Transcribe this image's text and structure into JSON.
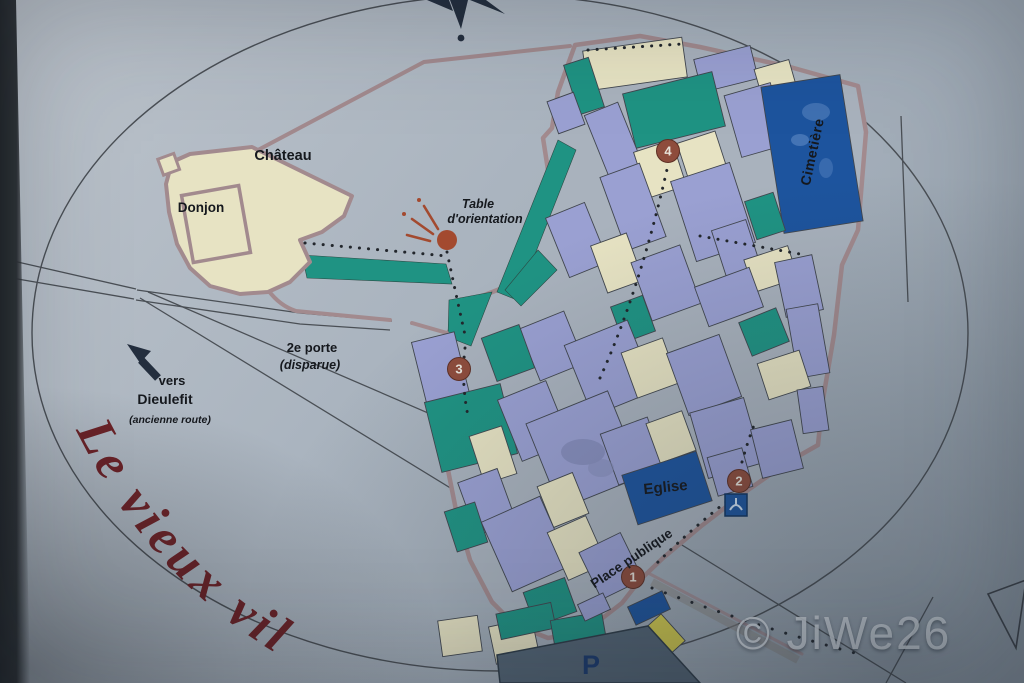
{
  "title_script": "Le vieux vil",
  "watermark": "© JiWe26",
  "labels": {
    "chateau": "Château",
    "donjon": "Donjon",
    "table_orientation_line1": "Table",
    "table_orientation_line2": "d'orientation",
    "porte_line1": "2e porte",
    "porte_line2": "(disparue)",
    "vers_line1": "vers",
    "vers_line2": "Dieulefit",
    "vers_line3": "(ancienne route)",
    "cimetiere": "Cimetière",
    "eglise": "Eglise",
    "place_publique": "Place publique",
    "parking": "P"
  },
  "markers": [
    {
      "num": "1",
      "x": 633,
      "y": 577
    },
    {
      "num": "2",
      "x": 739,
      "y": 481
    },
    {
      "num": "3",
      "x": 459,
      "y": 369
    },
    {
      "num": "4",
      "x": 668,
      "y": 151
    }
  ],
  "icons": {
    "compass_rose": "★",
    "direction_arrow": "➤",
    "viewpoint_dot": "●",
    "fountain": "▯"
  },
  "colors": {
    "building_lavender": "#9aa0d2",
    "building_cream": "#e7e3c3",
    "building_teal": "#1f9383",
    "building_blue": "#1d549e",
    "building_yellow": "#d6cd4d",
    "wall": "#a28a8e",
    "street": "#a9b2bd",
    "marker": "#8e4c3c",
    "viewpoint_dot": "#a34a2f",
    "script_red": "#6d2227",
    "ink": "#15181d",
    "line": "#4a4f55",
    "panel_light": "#bdc4cc",
    "panel_mid": "#aab4bf",
    "panel_dark": "#94a0ac",
    "parking_fill": "#536474",
    "parking_letter": "#1a3a6e"
  },
  "buildings": [
    [
      585,
      44,
      100,
      40,
      -8,
      "cream"
    ],
    [
      571,
      60,
      26,
      52,
      -18,
      "teal"
    ],
    [
      697,
      52,
      58,
      34,
      -14,
      "lav"
    ],
    [
      757,
      64,
      36,
      26,
      -16,
      "cream"
    ],
    [
      628,
      82,
      92,
      56,
      -14,
      "teal"
    ],
    [
      732,
      88,
      48,
      64,
      -16,
      "lav"
    ],
    [
      772,
      80,
      80,
      148,
      -9,
      "blue"
    ],
    [
      598,
      106,
      36,
      80,
      -22,
      "lav"
    ],
    [
      552,
      96,
      28,
      34,
      -20,
      "lav"
    ],
    [
      640,
      145,
      40,
      48,
      -18,
      "cream"
    ],
    [
      684,
      136,
      40,
      52,
      -18,
      "cream"
    ],
    [
      612,
      168,
      42,
      78,
      -20,
      "lav"
    ],
    [
      682,
      170,
      62,
      84,
      -18,
      "lav"
    ],
    [
      750,
      196,
      30,
      40,
      -18,
      "teal"
    ],
    [
      718,
      224,
      36,
      48,
      -18,
      "lav"
    ],
    [
      748,
      252,
      46,
      34,
      -18,
      "cream"
    ],
    [
      780,
      258,
      38,
      56,
      -12,
      "lav"
    ],
    [
      556,
      208,
      42,
      64,
      -22,
      "lav"
    ],
    [
      598,
      238,
      38,
      50,
      -20,
      "cream"
    ],
    [
      640,
      252,
      52,
      62,
      -20,
      "lav"
    ],
    [
      700,
      276,
      58,
      42,
      -20,
      "lav"
    ],
    [
      744,
      314,
      40,
      36,
      -22,
      "teal"
    ],
    [
      792,
      306,
      32,
      70,
      -10,
      "lav"
    ],
    [
      762,
      356,
      44,
      38,
      -18,
      "cream"
    ],
    [
      616,
      300,
      34,
      38,
      -20,
      "teal"
    ],
    [
      528,
      318,
      48,
      56,
      -22,
      "lav"
    ],
    [
      576,
      330,
      68,
      76,
      -22,
      "lav"
    ],
    [
      628,
      344,
      44,
      48,
      -20,
      "cream"
    ],
    [
      676,
      342,
      56,
      66,
      -20,
      "lav"
    ],
    [
      420,
      336,
      44,
      76,
      -14,
      "lav"
    ],
    [
      488,
      330,
      40,
      46,
      -20,
      "teal"
    ],
    [
      432,
      392,
      78,
      72,
      -14,
      "teal"
    ],
    [
      476,
      430,
      34,
      50,
      -18,
      "cream"
    ],
    [
      508,
      388,
      52,
      66,
      -22,
      "lav"
    ],
    [
      540,
      404,
      88,
      92,
      -22,
      "lav"
    ],
    [
      544,
      478,
      38,
      44,
      -22,
      "cream"
    ],
    [
      608,
      424,
      50,
      54,
      -20,
      "lav"
    ],
    [
      652,
      416,
      38,
      42,
      -20,
      "cream"
    ],
    [
      698,
      404,
      56,
      68,
      -16,
      "lav"
    ],
    [
      756,
      424,
      42,
      50,
      -14,
      "lav"
    ],
    [
      628,
      462,
      78,
      52,
      -18,
      "blue"
    ],
    [
      712,
      452,
      36,
      40,
      -16,
      "lav"
    ],
    [
      466,
      474,
      42,
      56,
      -20,
      "lav"
    ],
    [
      450,
      506,
      32,
      42,
      -18,
      "teal"
    ],
    [
      494,
      506,
      64,
      76,
      -24,
      "lav"
    ],
    [
      556,
      522,
      42,
      52,
      -24,
      "cream"
    ],
    [
      588,
      540,
      46,
      52,
      -26,
      "lav"
    ],
    [
      528,
      584,
      44,
      36,
      -20,
      "teal"
    ],
    [
      492,
      622,
      44,
      38,
      -12,
      "cream"
    ],
    [
      440,
      618,
      40,
      36,
      -8,
      "cream"
    ],
    [
      498,
      608,
      56,
      26,
      -12,
      "teal"
    ],
    [
      552,
      616,
      52,
      24,
      -10,
      "teal"
    ],
    [
      580,
      598,
      28,
      18,
      -25,
      "lav"
    ],
    [
      630,
      598,
      38,
      20,
      -25,
      "blue"
    ],
    [
      640,
      622,
      38,
      36,
      -42,
      "yellow"
    ],
    [
      800,
      388,
      26,
      44,
      -8,
      "lav"
    ]
  ]
}
